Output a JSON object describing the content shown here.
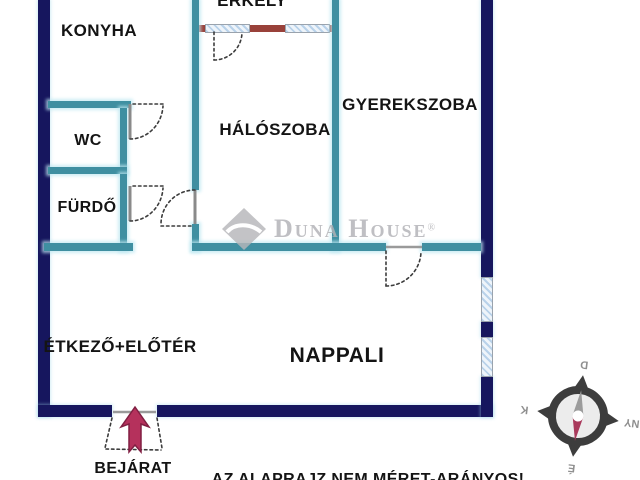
{
  "rooms": {
    "konyha": "KONYHA",
    "erkely": "ERKÉLY",
    "wc": "WC",
    "furdo": "FÜRDŐ",
    "haloszoba": "HÁLÓSZOBA",
    "gyerekszoba": "GYEREKSZOBA",
    "etkezo": "ÉTKEZŐ+ELŐTÉR",
    "nappali": "NAPPALI"
  },
  "entrance_label": "BEJÁRAT",
  "disclaimer": "AZ ALAPRAJZ NEM MÉRET-ARÁNYOS!",
  "watermark": {
    "text": "Duna House",
    "reg": "®"
  },
  "compass": {
    "north": "É",
    "south": "D",
    "east": "K",
    "west": "NY"
  },
  "colors": {
    "outer_wall": "#16165e",
    "inner_wall": "#3f8fa1",
    "balcony_wall": "#99413a",
    "window_hatch": "#b9d2ea",
    "entrance_arrow": "#b5315c",
    "watermark_gray": "#b2b2b6"
  }
}
